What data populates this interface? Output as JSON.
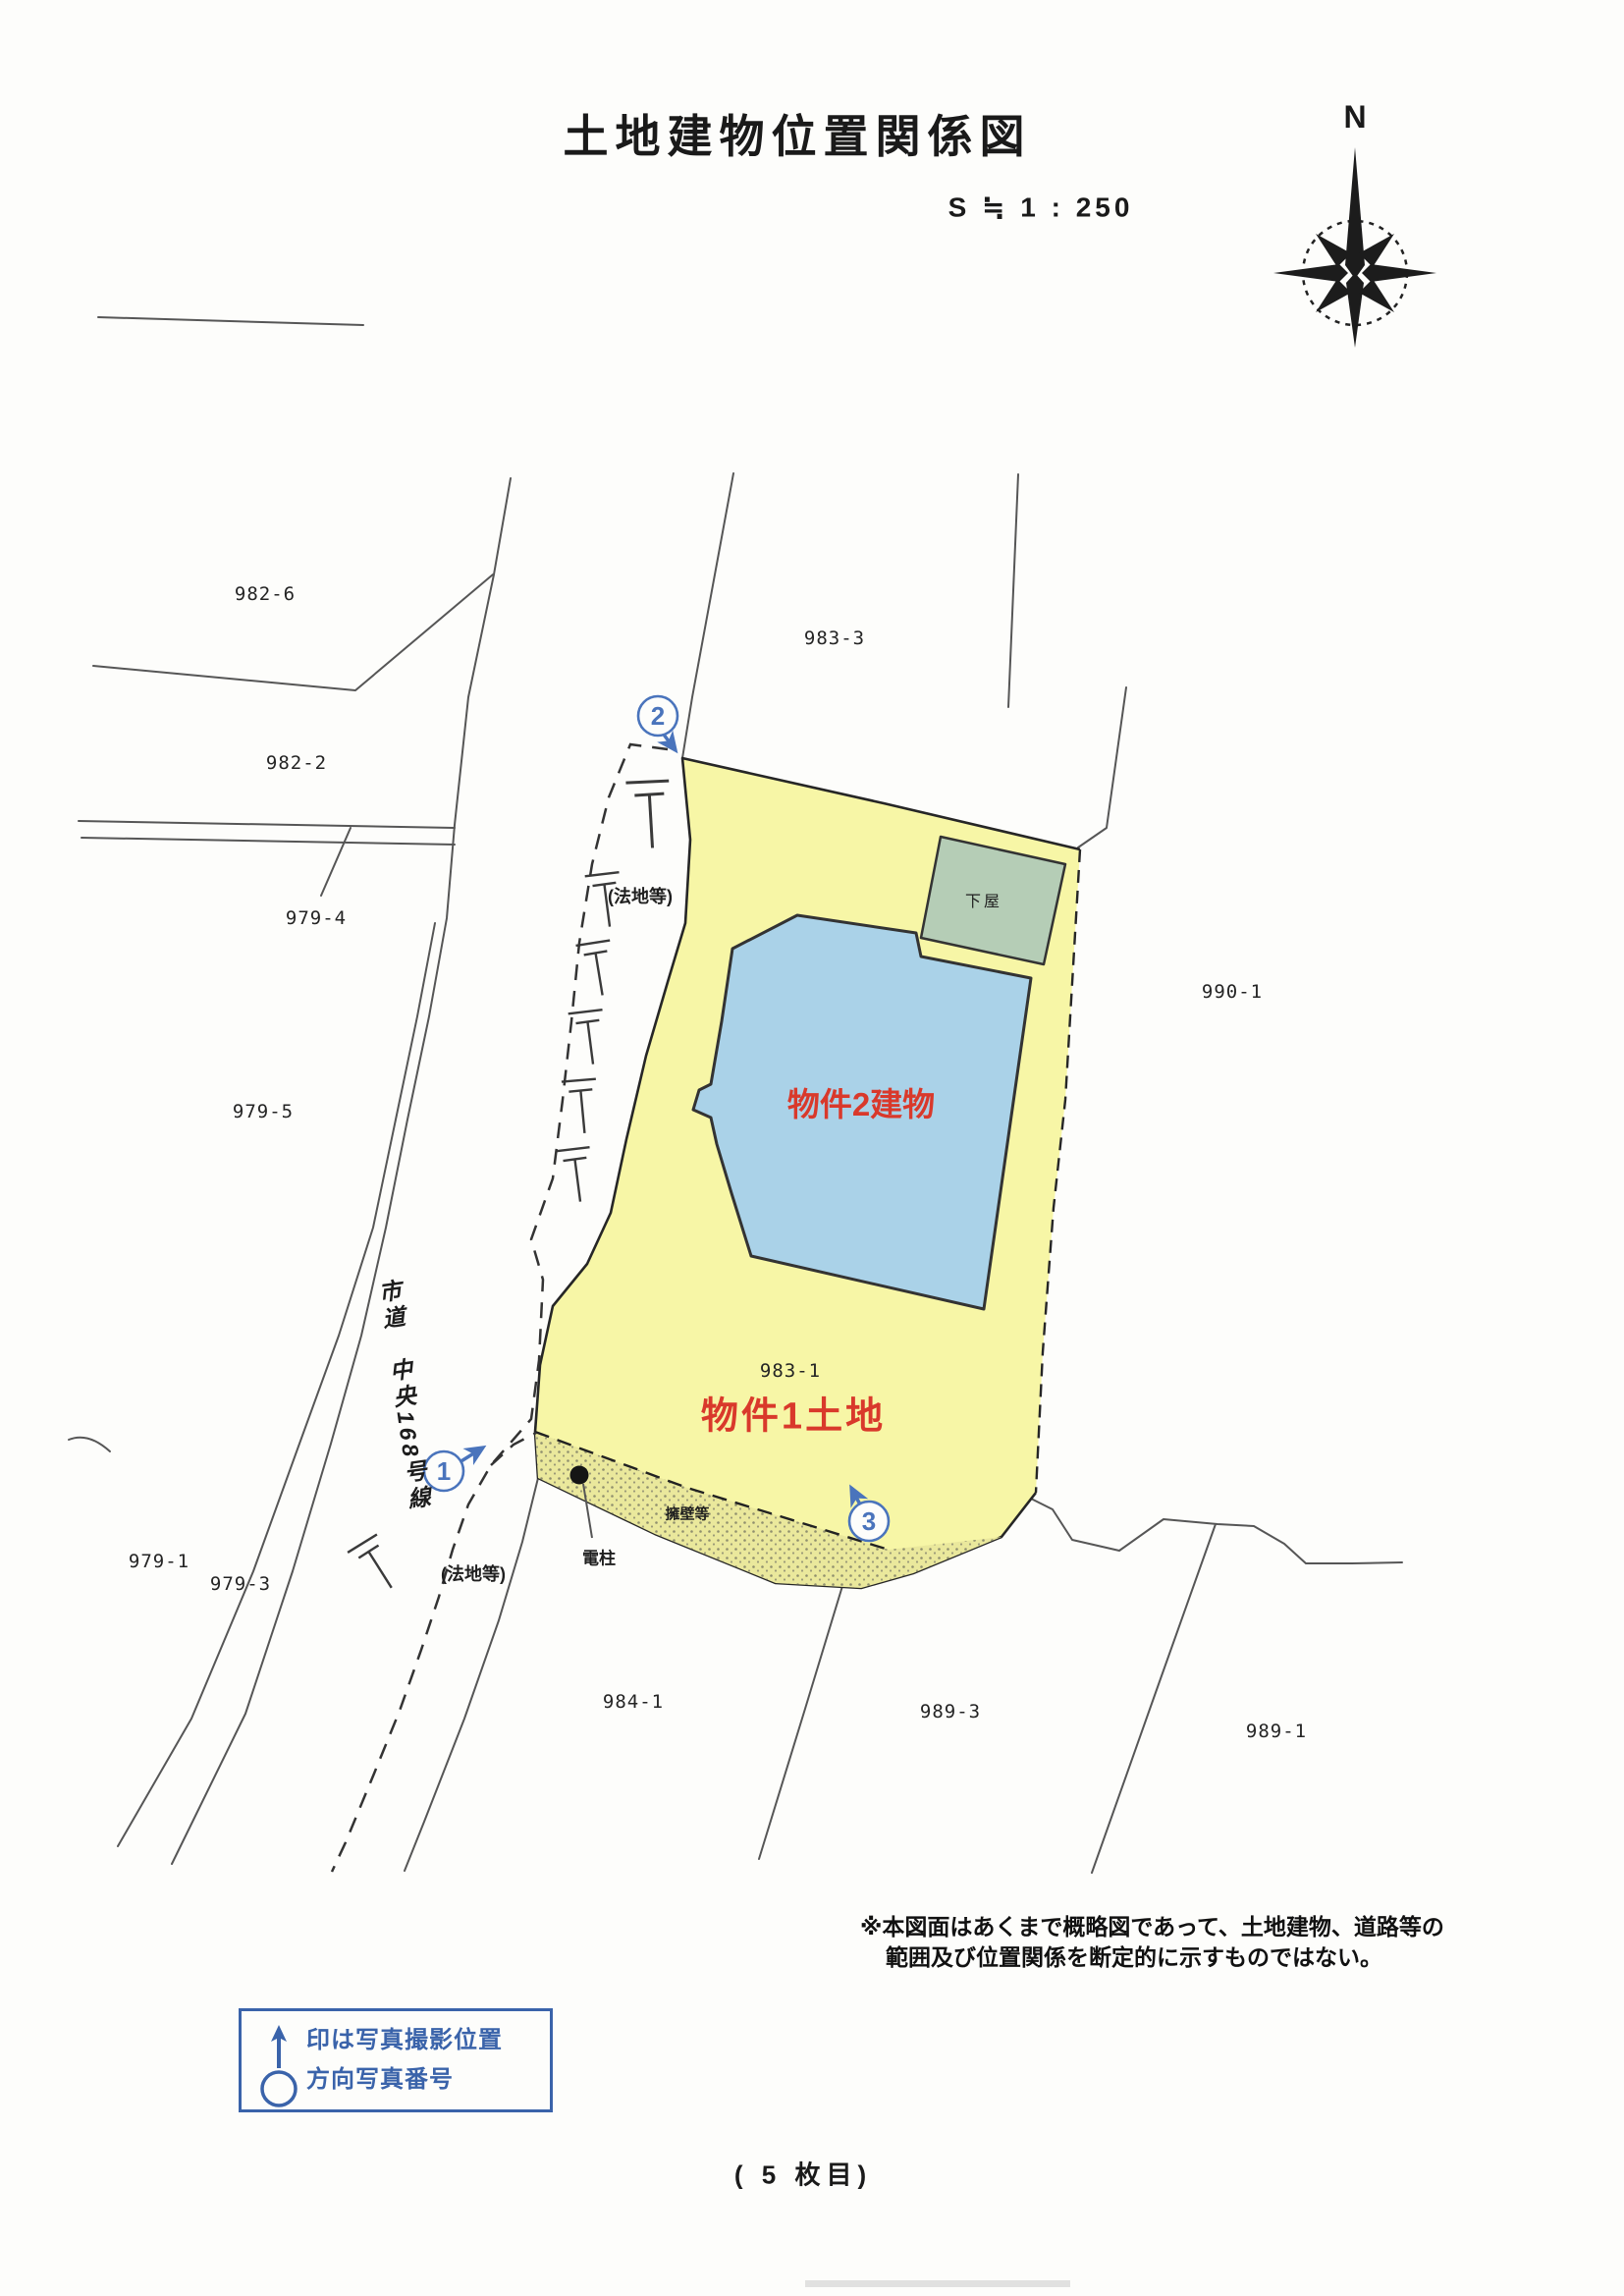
{
  "header": {
    "title": "土地建物位置関係図",
    "scale": "S ≒ 1 : 250",
    "compass_north": "N"
  },
  "map": {
    "parcels": [
      {
        "label": "982-6"
      },
      {
        "label": "982-2"
      },
      {
        "label": "979-4"
      },
      {
        "label": "979-5"
      },
      {
        "label": "979-1"
      },
      {
        "label": "979-3"
      },
      {
        "label": "983-3"
      },
      {
        "label": "990-1"
      },
      {
        "label": "983-1"
      },
      {
        "label": "984-1"
      },
      {
        "label": "989-3"
      },
      {
        "label": "989-1"
      }
    ],
    "property1_label": "物件1土地",
    "property2_label": "物件2建物",
    "shed_label": "下屋",
    "road_label": "市道　中央168号線",
    "slope_label_upper": "(法地等)",
    "slope_label_lower": "(法地等)",
    "retaining_wall_label": "擁壁等",
    "utility_pole_label": "電柱",
    "photo_markers": [
      {
        "num": "1"
      },
      {
        "num": "2"
      },
      {
        "num": "3"
      }
    ]
  },
  "note": {
    "line1": "※本図面はあくまで概略図であって、土地建物、道路等の",
    "line2": "範囲及び位置関係を断定的に示すものではない。"
  },
  "legend": {
    "line1": "印は写真撮影位置",
    "line2": "方向写真番号"
  },
  "footer": {
    "page_label": "( 5 枚目)"
  },
  "colors": {
    "parcel_yellow": "#f7f6a6",
    "building_blue": "#aad2e8",
    "shed_green": "#b5cdb6",
    "retaining_band": "#eae89c",
    "annotation_blue": "#4a74bc",
    "legend_blue": "#3a63aa",
    "property_red": "#d9392b"
  }
}
